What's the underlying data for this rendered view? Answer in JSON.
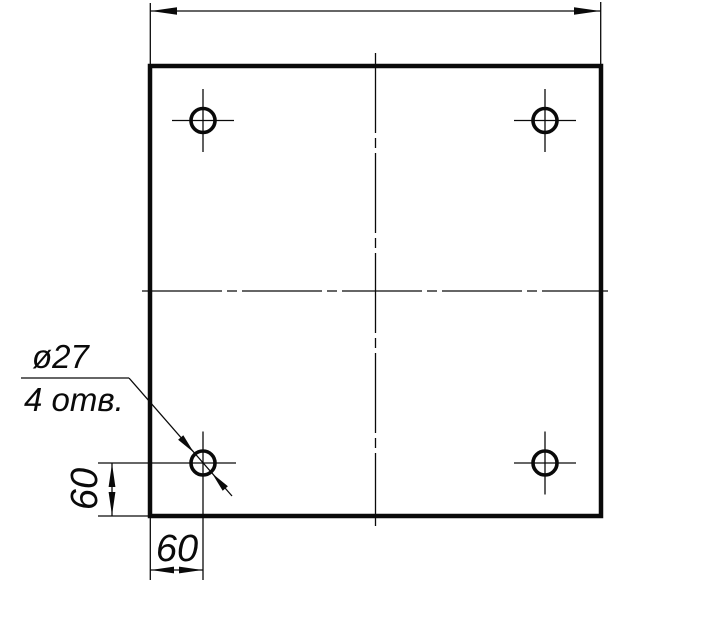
{
  "drawing": {
    "kind": "technical-drawing-plate-with-holes",
    "stroke_color": "#0a0a0a",
    "background_color": "#ffffff",
    "labels": {
      "hole_note_diameter": "ø27",
      "hole_note_count": "4 отв.",
      "bottom_offset_dim": "60",
      "left_offset_dim": "60"
    }
  }
}
